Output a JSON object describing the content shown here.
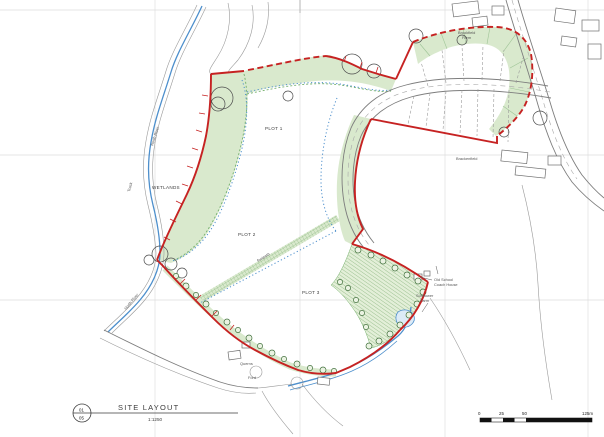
{
  "drawing": {
    "labels": {
      "plot1": "PLOT 1",
      "plot2": "PLOT 2",
      "plot3": "PLOT 3",
      "wetlands": "WETLANDS",
      "north_river_upper": "North River",
      "north_river_lower": "North River",
      "track": "Track",
      "brookfield_farm_1": "Brookfield",
      "brookfield_farm_2": "Farm",
      "brackenfield": "Brackenfield",
      "old_school": "Old School",
      "coach_house": "Coach House",
      "sunflower_1": "Sunflower",
      "sunflower_2": "Farm",
      "querns": "Querns",
      "ford": "Ford",
      "footpath": "footpath"
    },
    "colors": {
      "site_boundary": "#c62222",
      "landscape_fill": "#d9e9cd",
      "landscape_edge": "#74b06c",
      "water": "#4d8fcc",
      "road": "#7d7d7d",
      "grid": "#dedede"
    }
  },
  "title_block": {
    "sheet_no_top": "01",
    "sheet_no_bottom": "05",
    "title": "SITE LAYOUT",
    "scale": "1:1250"
  },
  "scale_bar": {
    "ticks": [
      "0",
      "25",
      "50",
      "125m"
    ]
  }
}
